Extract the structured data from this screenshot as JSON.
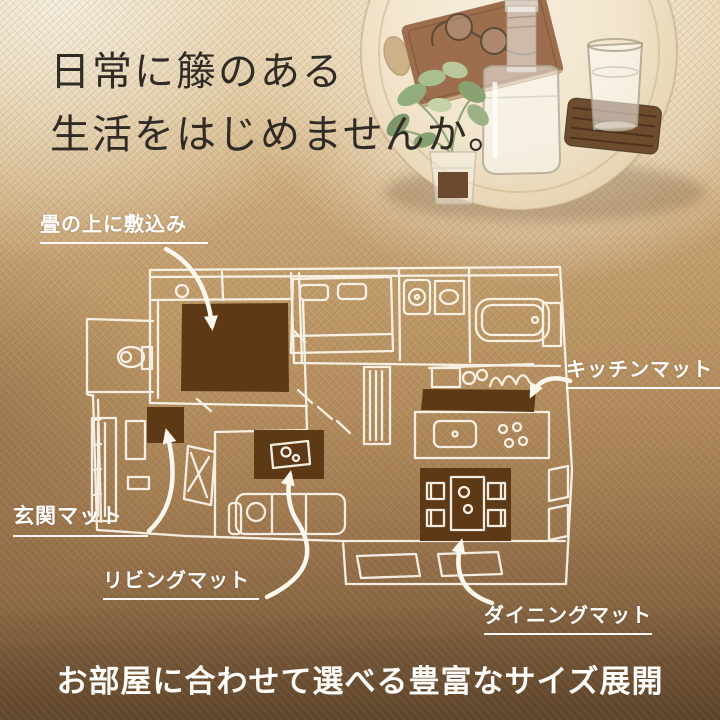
{
  "hero": {
    "headline_line1": "日常に籐のある",
    "headline_line2": "生活をはじめませんか。"
  },
  "floorplan": {
    "labels": {
      "tatami": "畳の上に敷込み",
      "kitchen": "キッチンマット",
      "entrance": "玄関マット",
      "living": "リビングマット",
      "dining": "ダイニングマット"
    },
    "mat_color": "#5d3a15",
    "sketch_color": "#fdf8ee"
  },
  "footer": {
    "caption": "お部屋に合わせて選べる豊富なサイズ展開"
  },
  "photo": {
    "items": [
      "round-wood-tray",
      "book",
      "eyeglasses",
      "glass-water-bottle",
      "drinking-glass",
      "woven-coaster",
      "potted-plant"
    ],
    "tray_color": "#f2e6d0",
    "coaster_color": "#6d4b2d",
    "book_color": "#9c6e4d",
    "leaf_color": "#93ac7c"
  },
  "colors": {
    "headline_text": "#302b25",
    "label_text": "#ffffff",
    "background_light": "#f2e8d2",
    "background_mid": "#c9a672",
    "background_dark": "#694e33"
  }
}
